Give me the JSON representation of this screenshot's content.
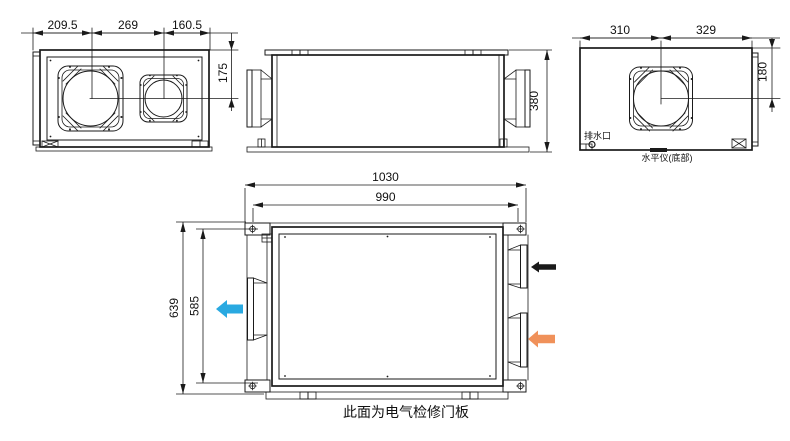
{
  "colors": {
    "line": "#1a1a1a",
    "exhaust_arrow": "#29A9E1",
    "return_arrow": "#1a1a1a",
    "fresh_arrow": "#F0915A"
  },
  "views": {
    "front": {
      "duct1_offset": "209.5",
      "duct_spacing": "269",
      "duct2_offset": "160.5",
      "duct_center_height": "175"
    },
    "side": {
      "height": "380"
    },
    "end": {
      "duct_offset_left": "310",
      "duct_offset_right": "329",
      "duct_center_height": "180",
      "drain_label": "排水口",
      "level_label": "水平仪(底部)"
    },
    "plan": {
      "overall_length": "1030",
      "case_length": "990",
      "overall_depth": "639",
      "case_depth": "585",
      "note": "此面为电气检修门板"
    }
  }
}
